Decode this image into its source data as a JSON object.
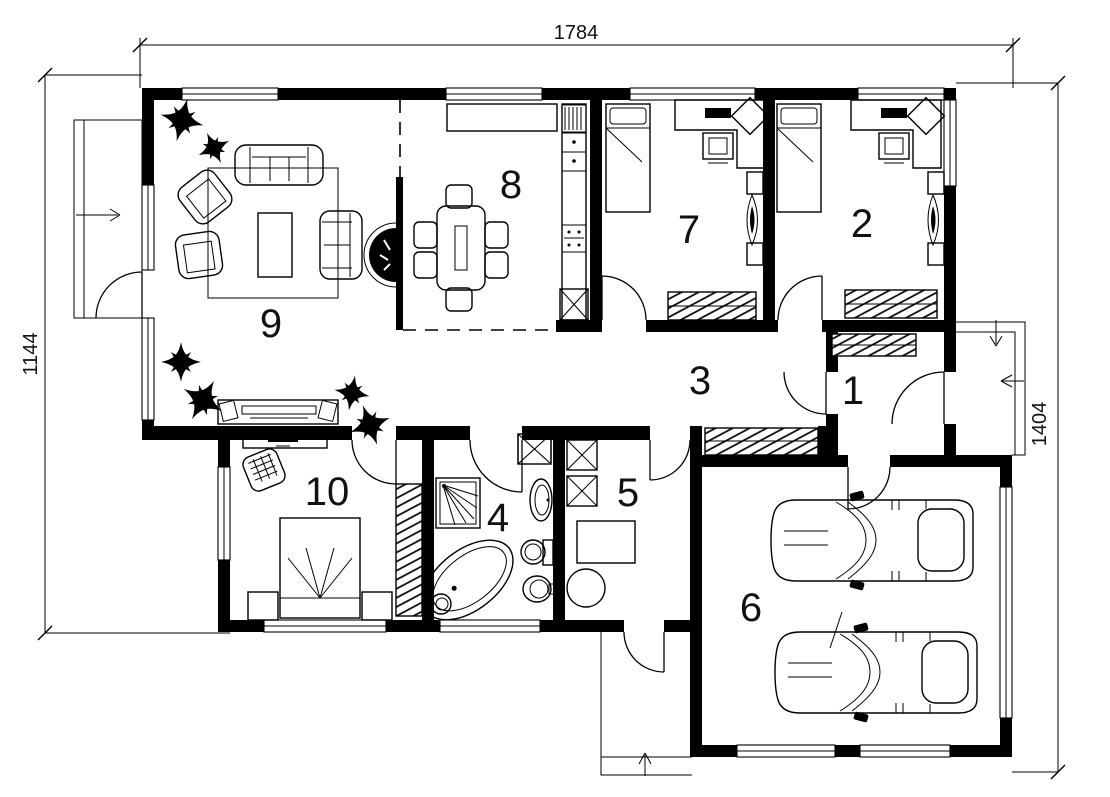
{
  "drawing": {
    "title": "single-storey house floor plan",
    "background_color": "#ffffff",
    "line_color": "#000000"
  },
  "dimensions": {
    "top": "1784",
    "left": "1144",
    "right": "1404"
  },
  "rooms": [
    {
      "number": "1",
      "type": "entrance-hall"
    },
    {
      "number": "2",
      "type": "bedroom"
    },
    {
      "number": "3",
      "type": "hallway"
    },
    {
      "number": "4",
      "type": "bathroom"
    },
    {
      "number": "5",
      "type": "utility-room"
    },
    {
      "number": "6",
      "type": "garage"
    },
    {
      "number": "7",
      "type": "bedroom"
    },
    {
      "number": "8",
      "type": "kitchen-dining"
    },
    {
      "number": "9",
      "type": "living-room"
    },
    {
      "number": "10",
      "type": "bedroom"
    }
  ]
}
